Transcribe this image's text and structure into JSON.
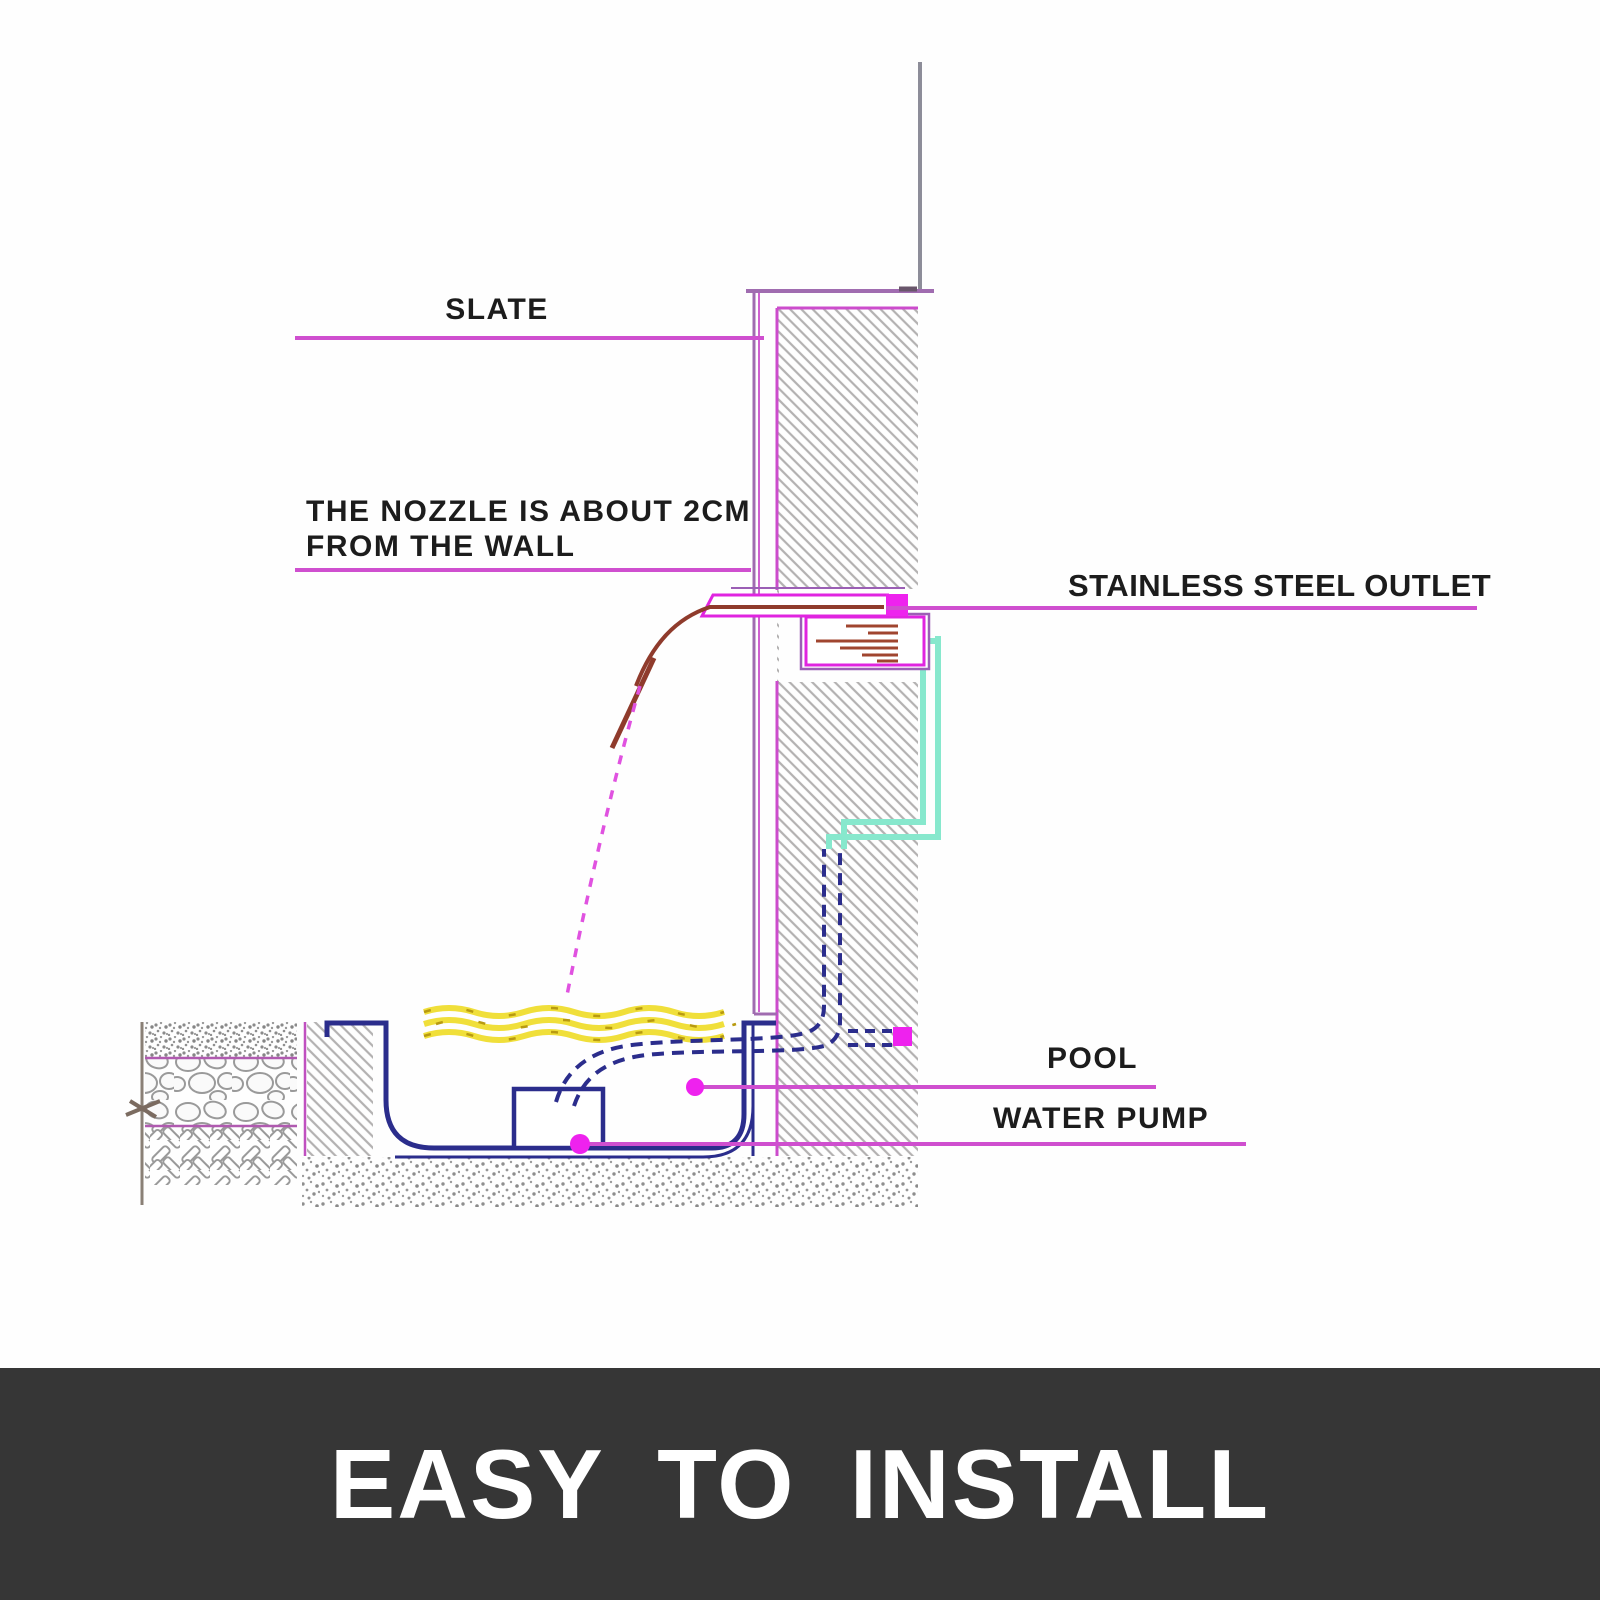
{
  "banner": {
    "text": "EASY TO INSTALL",
    "background": "#363636",
    "text_color": "#ffffff"
  },
  "diagram": {
    "title": "waterfall fountain wall installation cross-section",
    "labels": {
      "slate": "SLATE",
      "nozzle_line1": "THE NOZZLE IS ABOUT 2CM",
      "nozzle_line2": "FROM THE WALL",
      "stainless_steel_outlet": "STAINLESS STEEL OUTLET",
      "pool": "POOL",
      "water_pump": "WATER PUMP"
    },
    "colors": {
      "leader_line": "#cf4fcf",
      "marker_dot": "#ee22ee",
      "slate_line": "#a06cb0",
      "wall_border": "#cc4ccc",
      "wall_hatch": "#b3b1b1",
      "pool_liner": "#2b2d8c",
      "pipe": "#2b2d8c",
      "water_surface_yellow": "#f0df3a",
      "water_stream_brown": "#8f3b2c",
      "stream_dashed_magenta": "#e052e0",
      "conduit_teal": "#87e8cd",
      "ground_gray": "#8a8076",
      "label_text": "#1c1c1c"
    },
    "components": [
      "wall with brick hatch",
      "slate facing",
      "stainless steel outlet with reservoir",
      "water stream from nozzle",
      "pool water surface",
      "pool basin liner",
      "water pump",
      "suction pipes (dashed)",
      "conduit outline (teal)",
      "ground layers: topsoil, cobblestone, subbase",
      "gravel base"
    ]
  }
}
